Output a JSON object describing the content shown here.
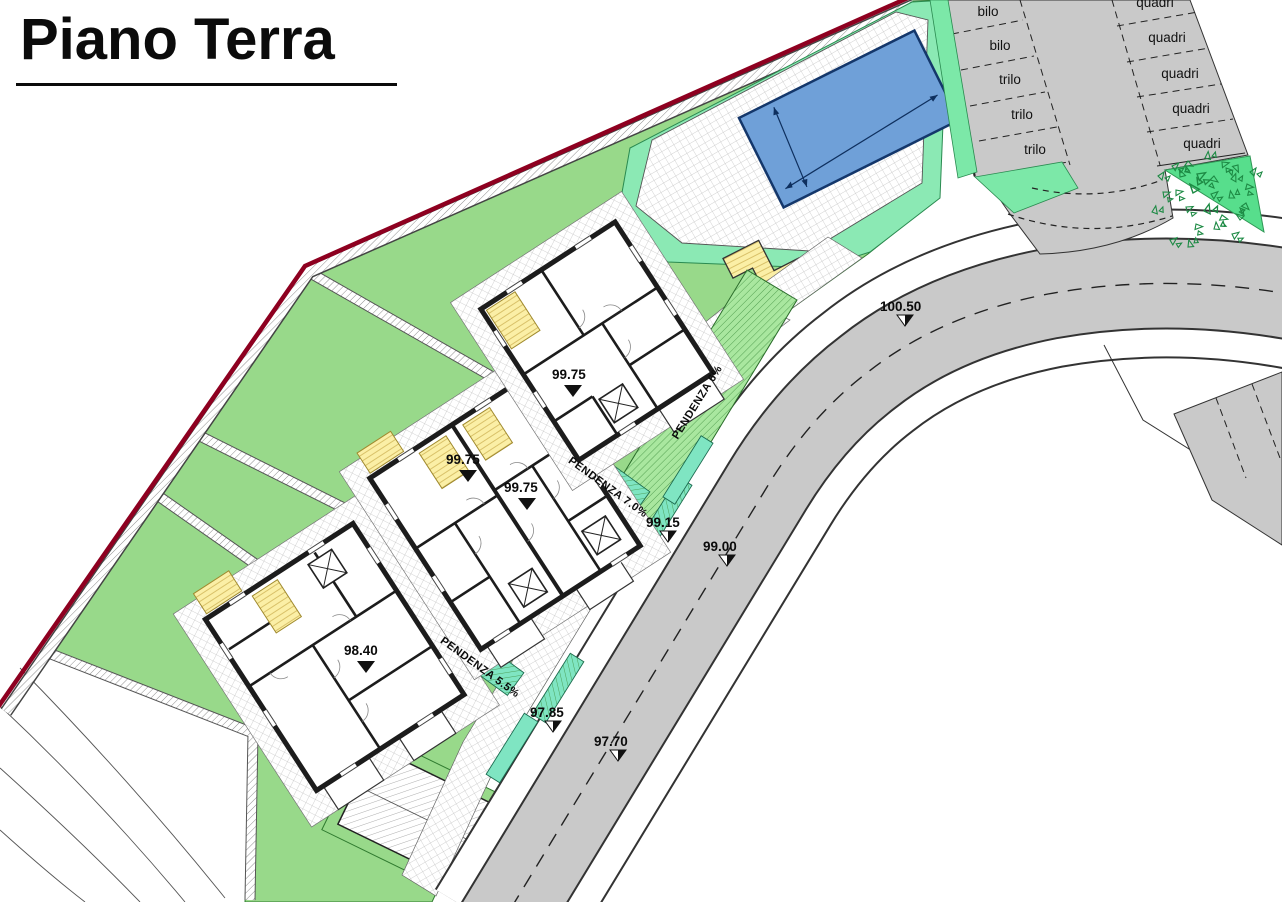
{
  "title": "Piano Terra",
  "parking_top": {
    "left_labels": [
      "bilo",
      "bilo",
      "trilo",
      "trilo",
      "trilo"
    ],
    "right_labels": [
      "quadri",
      "quadri",
      "quadri",
      "quadri",
      "quadri"
    ]
  },
  "slopes": {
    "road_ramp": "PENDENZA 6%",
    "mid_ramp": "PENDENZA 7.0%",
    "lower_ramp": "PENDENZA 5.5%"
  },
  "elevations": {
    "road_top": "100.50",
    "sidewalk_mid": "99.15",
    "road_mid": "99.00",
    "sidewalk_low": "97.85",
    "road_low": "97.70",
    "building_a": "99.75",
    "building_b_left": "99.75",
    "building_b_right": "99.75",
    "building_c": "98.40"
  },
  "colors": {
    "boundary_red": "#8E0020",
    "lawn_green": "#98D98A",
    "mint_green": "#8BE9B4",
    "teal_ramp": "#7FE5C2",
    "ramp_green": "#A9E79F",
    "pool_blue": "#6FA0D8",
    "road_gray": "#C9C9C9",
    "stairs_yellow": "#FBEFA6"
  }
}
